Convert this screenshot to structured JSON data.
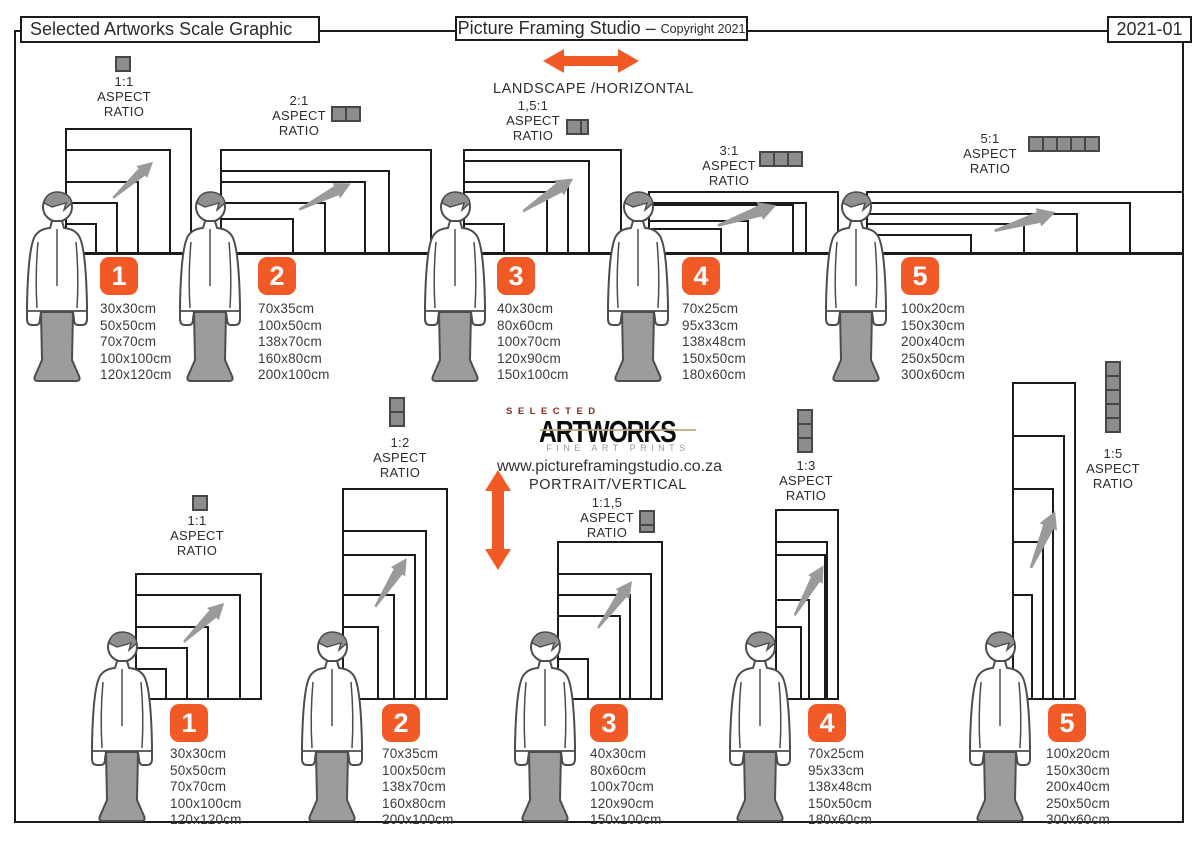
{
  "header": {
    "left_title": "Selected Artworks Scale Graphic",
    "studio_title": "Picture Framing Studio –",
    "copyright": "Copyright 2021",
    "doc_number": "2021-01"
  },
  "labels": {
    "aspect": "ASPECT",
    "ratio": "RATIO"
  },
  "landscape": {
    "section_label": "LANDSCAPE /HORIZONTAL",
    "groups": [
      {
        "number": "1",
        "ratio": "1:1",
        "sizes": [
          "30x30cm",
          "50x50cm",
          "70x70cm",
          "100x100cm",
          "120x120cm"
        ]
      },
      {
        "number": "2",
        "ratio": "2:1",
        "sizes": [
          "70x35cm",
          "100x50cm",
          "138x70cm",
          "160x80cm",
          "200x100cm"
        ]
      },
      {
        "number": "3",
        "ratio": "1,5:1",
        "sizes": [
          "40x30cm",
          "80x60cm",
          "100x70cm",
          "120x90cm",
          "150x100cm"
        ]
      },
      {
        "number": "4",
        "ratio": "3:1",
        "sizes": [
          "70x25cm",
          "95x33cm",
          "138x48cm",
          "150x50cm",
          "180x60cm"
        ]
      },
      {
        "number": "5",
        "ratio": "5:1",
        "sizes": [
          "100x20cm",
          "150x30cm",
          "200x40cm",
          "250x50cm",
          "300x60cm"
        ]
      }
    ]
  },
  "portrait": {
    "section_label": "PORTRAIT/VERTICAL",
    "groups": [
      {
        "number": "1",
        "ratio": "1:1",
        "sizes": [
          "30x30cm",
          "50x50cm",
          "70x70cm",
          "100x100cm",
          "120x120cm"
        ]
      },
      {
        "number": "2",
        "ratio": "1:2",
        "sizes": [
          "70x35cm",
          "100x50cm",
          "138x70cm",
          "160x80cm",
          "200x100cm"
        ]
      },
      {
        "number": "3",
        "ratio": "1:1,5",
        "sizes": [
          "40x30cm",
          "80x60cm",
          "100x70cm",
          "120x90cm",
          "150x100cm"
        ]
      },
      {
        "number": "4",
        "ratio": "1:3",
        "sizes": [
          "70x25cm",
          "95x33cm",
          "138x48cm",
          "150x50cm",
          "180x60cm"
        ]
      },
      {
        "number": "5",
        "ratio": "1:5",
        "sizes": [
          "100x20cm",
          "150x30cm",
          "200x40cm",
          "250x50cm",
          "300x60cm"
        ]
      }
    ]
  },
  "logo": {
    "selected": "SELECTED",
    "artworks": "ARTWORKS",
    "tagline": "FINE ART PRINTS",
    "url": "www.pictureframingstudio.co.za"
  },
  "colors": {
    "accent": "#F15A27",
    "square_gray": "#8D8D8D",
    "figure_gray": "#9C9C9C",
    "arrow_gray": "#9A9A9A",
    "line_dark": "#1B1B1B",
    "logo_red": "#7E2F1F"
  },
  "icons": {
    "aspect_unit_square": "gray-square-icon",
    "landscape_direction": "double-horizontal-arrow-icon",
    "portrait_direction": "double-vertical-arrow-icon",
    "scale_growth": "diagonal-arrow-icon",
    "human_scale": "person-silhouette-icon"
  }
}
